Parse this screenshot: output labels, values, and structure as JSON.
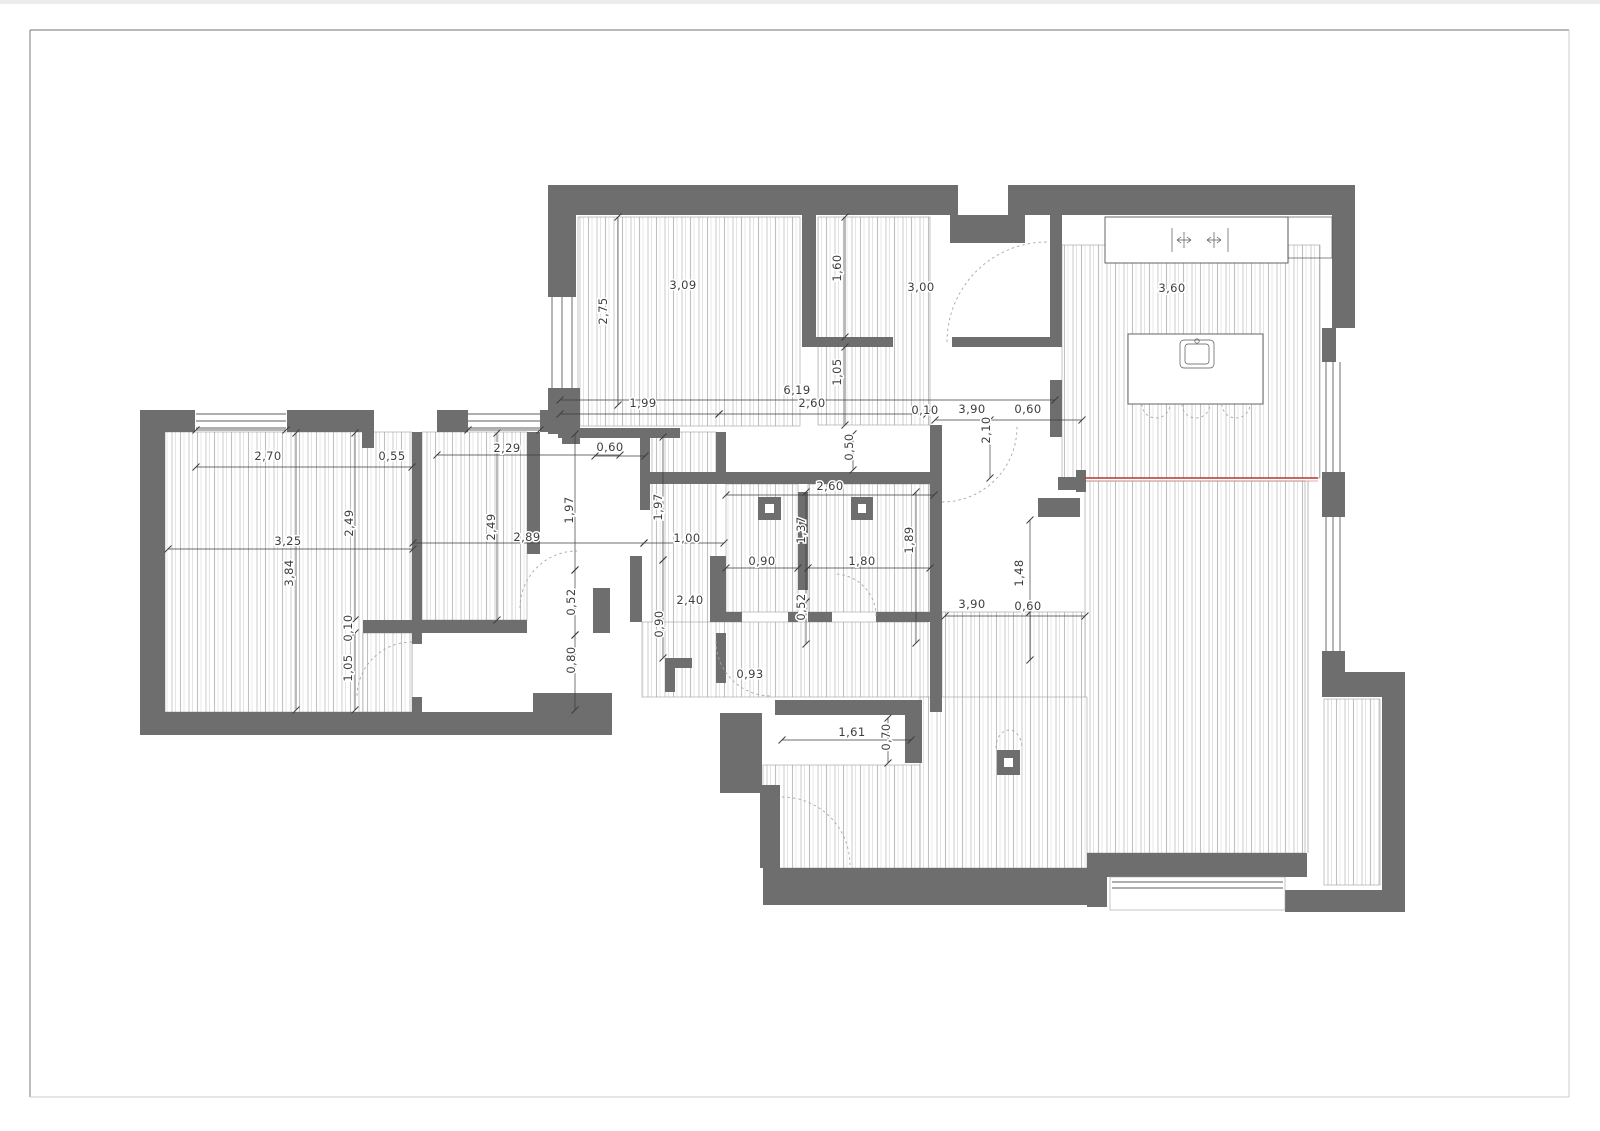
{
  "sheet": {
    "background": "#ffffff",
    "frame_color": "#8f8f8f",
    "frame_light_color": "#cccccc"
  },
  "colors": {
    "wall": "#6e6e6e",
    "hatch": "#c6c6c6",
    "dim_text": "#3d3d3d",
    "fixture": "#555555",
    "door_arc": "#a6a6a6",
    "red_line": "#b5342c",
    "room_outline": "#9d9d9d"
  },
  "drawing": {
    "type": "apartment floor plan",
    "units": "meters",
    "symbol_counts": {
      "vent_shafts": 3,
      "door_swings": 7,
      "windows": 6,
      "kitchen_chairs": 3
    }
  },
  "dimension_labels": [
    {
      "t": "2,75",
      "x": 607,
      "y": 311,
      "r": -90
    },
    {
      "t": "3,09",
      "x": 683,
      "y": 289,
      "r": 0
    },
    {
      "t": "1,60",
      "x": 841,
      "y": 268,
      "r": -90
    },
    {
      "t": "3,00",
      "x": 921,
      "y": 291,
      "r": 0
    },
    {
      "t": "3,60",
      "x": 1172,
      "y": 292,
      "r": 0
    },
    {
      "t": "1,05",
      "x": 841,
      "y": 372,
      "r": -90
    },
    {
      "t": "6,19",
      "x": 797,
      "y": 394,
      "r": 0
    },
    {
      "t": "2,60",
      "x": 812,
      "y": 407,
      "r": 0
    },
    {
      "t": "1,99",
      "x": 643,
      "y": 407,
      "r": 0
    },
    {
      "t": "0,10",
      "x": 925,
      "y": 414,
      "r": 0
    },
    {
      "t": "3,90",
      "x": 972,
      "y": 413,
      "r": 0
    },
    {
      "t": "0,60",
      "x": 1028,
      "y": 413,
      "r": 0
    },
    {
      "t": "2,10",
      "x": 990,
      "y": 430,
      "r": -90
    },
    {
      "t": "0,50",
      "x": 853,
      "y": 447,
      "r": -90
    },
    {
      "t": "0,60",
      "x": 610,
      "y": 451,
      "r": 0
    },
    {
      "t": "2,70",
      "x": 268,
      "y": 460,
      "r": 0
    },
    {
      "t": "0,55",
      "x": 392,
      "y": 460,
      "r": 0
    },
    {
      "t": "2,29",
      "x": 507,
      "y": 452,
      "r": 0
    },
    {
      "t": "1,97",
      "x": 573,
      "y": 510,
      "r": -90
    },
    {
      "t": "1,97",
      "x": 662,
      "y": 507,
      "r": -90
    },
    {
      "t": "2,49",
      "x": 353,
      "y": 523,
      "r": -90
    },
    {
      "t": "2,49",
      "x": 495,
      "y": 527,
      "r": -90
    },
    {
      "t": "3,25",
      "x": 288,
      "y": 545,
      "r": 0
    },
    {
      "t": "3,84",
      "x": 293,
      "y": 573,
      "r": -90
    },
    {
      "t": "2,89",
      "x": 527,
      "y": 541,
      "r": 0
    },
    {
      "t": "1,00",
      "x": 687,
      "y": 542,
      "r": 0
    },
    {
      "t": "2,60",
      "x": 830,
      "y": 490,
      "r": 0
    },
    {
      "t": "1,37",
      "x": 805,
      "y": 530,
      "r": -90
    },
    {
      "t": "1,89",
      "x": 913,
      "y": 540,
      "r": -90
    },
    {
      "t": "0,90",
      "x": 762,
      "y": 565,
      "r": 0
    },
    {
      "t": "1,80",
      "x": 862,
      "y": 565,
      "r": 0
    },
    {
      "t": "0,52",
      "x": 575,
      "y": 602,
      "r": -90
    },
    {
      "t": "0,52",
      "x": 805,
      "y": 607,
      "r": -90
    },
    {
      "t": "2,40",
      "x": 690,
      "y": 604,
      "r": 0
    },
    {
      "t": "0,90",
      "x": 663,
      "y": 624,
      "r": -90
    },
    {
      "t": "0,80",
      "x": 575,
      "y": 660,
      "r": -90
    },
    {
      "t": "0,10",
      "x": 352,
      "y": 628,
      "r": -90
    },
    {
      "t": "1,05",
      "x": 352,
      "y": 668,
      "r": -90
    },
    {
      "t": "0,93",
      "x": 750,
      "y": 678,
      "r": 0
    },
    {
      "t": "3,90",
      "x": 972,
      "y": 608,
      "r": 0
    },
    {
      "t": "0,60",
      "x": 1028,
      "y": 610,
      "r": 0
    },
    {
      "t": "1,48",
      "x": 1023,
      "y": 573,
      "r": -90
    },
    {
      "t": "1,61",
      "x": 852,
      "y": 736,
      "r": 0
    },
    {
      "t": "0,70",
      "x": 890,
      "y": 737,
      "r": -90
    }
  ],
  "dim_lines": [
    [
      618,
      217,
      618,
      405
    ],
    [
      845,
      217,
      845,
      337
    ],
    [
      845,
      347,
      845,
      425
    ],
    [
      560,
      400,
      1055,
      400
    ],
    [
      560,
      414,
      719,
      414
    ],
    [
      719,
      414,
      927,
      414
    ],
    [
      935,
      420,
      1082,
      420
    ],
    [
      990,
      420,
      990,
      478
    ],
    [
      853,
      434,
      853,
      470
    ],
    [
      595,
      456,
      645,
      456
    ],
    [
      437,
      455,
      620,
      455
    ],
    [
      196,
      467,
      412,
      467
    ],
    [
      168,
      549,
      413,
      549
    ],
    [
      413,
      543,
      644,
      543
    ],
    [
      644,
      543,
      724,
      543
    ],
    [
      296,
      433,
      296,
      710
    ],
    [
      355,
      433,
      355,
      620
    ],
    [
      355,
      633,
      355,
      710
    ],
    [
      497,
      433,
      497,
      620
    ],
    [
      575,
      434,
      575,
      570
    ],
    [
      575,
      570,
      575,
      635
    ],
    [
      575,
      635,
      575,
      710
    ],
    [
      663,
      437,
      663,
      560
    ],
    [
      663,
      560,
      663,
      658
    ],
    [
      806,
      492,
      806,
      602
    ],
    [
      806,
      602,
      806,
      644
    ],
    [
      916,
      492,
      916,
      643
    ],
    [
      726,
      495,
      934,
      495
    ],
    [
      726,
      568,
      798,
      568
    ],
    [
      808,
      568,
      930,
      568
    ],
    [
      945,
      616,
      1085,
      616
    ],
    [
      1030,
      520,
      1030,
      612
    ],
    [
      1030,
      612,
      1030,
      660
    ],
    [
      782,
      740,
      911,
      740
    ],
    [
      888,
      718,
      888,
      763
    ],
    [
      196,
      430,
      286,
      430
    ],
    [
      468,
      430,
      540,
      430
    ]
  ]
}
